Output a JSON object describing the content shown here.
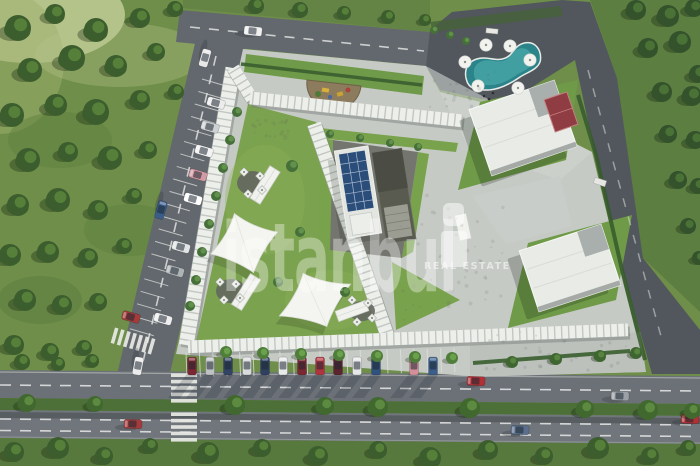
{
  "meta": {
    "caption": "Aerial 3D architectural site-plan rendering"
  },
  "watermark": {
    "brand": "istanbul",
    "tagline": "REAL ESTATE",
    "logo": "i-building-logo"
  },
  "palette": {
    "grass": "#6e8e49",
    "grass_dark": "#5c7e41",
    "grass_bottom": "#58793e",
    "grass_light": "#cbd49f",
    "lawn": "#79a24d",
    "lawn_bright": "#8fb35c",
    "hedge": "#3a5f2f",
    "tree": "#3c5d2d",
    "tree_light": "#56803a",
    "tree_dark": "#34522b",
    "tree_dark_light": "#4a7136",
    "road": "#62686d",
    "road_light": "#70767c",
    "asphalt_dark": "#4d5358",
    "road_right": "#575d63",
    "plaza": "#c6cac5",
    "plaza_shade": "#b7bcb8",
    "colonnade": "#edefeb",
    "colonnade_rib": "#c2c7c2",
    "colonnade_shadow": "#777c78",
    "roof_white": "#e9ebe7",
    "roof_gray": "#a9afad",
    "solar": "#2a4d7a",
    "solar_grid": "#b9c6d8",
    "pool": "#2a8489",
    "pool_light": "#46a3a6",
    "court_red": "#8f3c42",
    "sail": "#f4f5f0",
    "marking": "#e8e8e8",
    "median_green": "#4c7038",
    "pad_gray": "#74756e",
    "kiosk_white": "#f1f2ee"
  },
  "scene": {
    "trees": {
      "field": [
        [
          18,
          28,
          13
        ],
        [
          55,
          14,
          10
        ],
        [
          96,
          30,
          12
        ],
        [
          140,
          18,
          10
        ],
        [
          175,
          9,
          8
        ],
        [
          30,
          70,
          12
        ],
        [
          72,
          58,
          13
        ],
        [
          116,
          66,
          11
        ],
        [
          156,
          52,
          9
        ],
        [
          12,
          115,
          12
        ],
        [
          56,
          105,
          11
        ],
        [
          96,
          112,
          13
        ],
        [
          140,
          100,
          10
        ],
        [
          176,
          92,
          8
        ],
        [
          28,
          160,
          12
        ],
        [
          68,
          152,
          10
        ],
        [
          110,
          158,
          12
        ],
        [
          148,
          150,
          9
        ],
        [
          18,
          205,
          11
        ],
        [
          58,
          200,
          12
        ],
        [
          98,
          210,
          10
        ],
        [
          134,
          196,
          8
        ],
        [
          10,
          255,
          11
        ],
        [
          48,
          252,
          11
        ],
        [
          88,
          258,
          10
        ],
        [
          124,
          246,
          8
        ],
        [
          25,
          300,
          11
        ],
        [
          62,
          305,
          10
        ],
        [
          98,
          302,
          9
        ],
        [
          14,
          345,
          10
        ],
        [
          50,
          352,
          9
        ],
        [
          84,
          348,
          8
        ],
        [
          22,
          362,
          8
        ],
        [
          58,
          364,
          7
        ],
        [
          92,
          361,
          7
        ]
      ],
      "topRight": [
        [
          636,
          10,
          10
        ],
        [
          668,
          16,
          11
        ],
        [
          694,
          8,
          9
        ],
        [
          648,
          48,
          10
        ],
        [
          680,
          42,
          11
        ],
        [
          698,
          74,
          9
        ],
        [
          662,
          92,
          10
        ],
        [
          692,
          96,
          10
        ],
        [
          668,
          134,
          9
        ],
        [
          695,
          140,
          9
        ],
        [
          678,
          180,
          9
        ],
        [
          698,
          186,
          8
        ],
        [
          688,
          226,
          8
        ],
        [
          699,
          258,
          7
        ]
      ],
      "bottom": [
        [
          14,
          452,
          10
        ],
        [
          58,
          448,
          11
        ],
        [
          104,
          456,
          9
        ],
        [
          150,
          446,
          8
        ],
        [
          208,
          453,
          11
        ],
        [
          262,
          448,
          9
        ],
        [
          318,
          456,
          10
        ],
        [
          378,
          450,
          9
        ],
        [
          430,
          458,
          11
        ],
        [
          488,
          450,
          10
        ],
        [
          544,
          456,
          9
        ],
        [
          598,
          448,
          11
        ],
        [
          650,
          456,
          9
        ],
        [
          688,
          448,
          8
        ]
      ],
      "topBand": [
        [
          256,
          6,
          8
        ],
        [
          300,
          10,
          8
        ],
        [
          344,
          13,
          7
        ],
        [
          388,
          17,
          7
        ],
        [
          425,
          20,
          6
        ]
      ],
      "median": [
        [
          27,
          403,
          9
        ],
        [
          95,
          404,
          8
        ],
        [
          235,
          405,
          10
        ],
        [
          325,
          406,
          9
        ],
        [
          378,
          407,
          10
        ],
        [
          470,
          408,
          10
        ],
        [
          585,
          409,
          9
        ],
        [
          648,
          410,
          10
        ],
        [
          692,
          411,
          8
        ]
      ]
    },
    "shrubs": [
      [
        237,
        112,
        5
      ],
      [
        230,
        140,
        5
      ],
      [
        223,
        168,
        5
      ],
      [
        216,
        196,
        5
      ],
      [
        209,
        224,
        5
      ],
      [
        202,
        252,
        5
      ],
      [
        196,
        280,
        5
      ],
      [
        190,
        306,
        5
      ],
      [
        292,
        166,
        6
      ],
      [
        300,
        232,
        5
      ],
      [
        278,
        282,
        5
      ],
      [
        345,
        292,
        5
      ],
      [
        434,
        30,
        4
      ],
      [
        450,
        35,
        4
      ],
      [
        466,
        41,
        4
      ],
      [
        330,
        134,
        4
      ],
      [
        360,
        138,
        4
      ],
      [
        390,
        143,
        4
      ],
      [
        418,
        147,
        4
      ]
    ],
    "hedgeTrees": [
      [
        512,
        362,
        6
      ],
      [
        556,
        359,
        6
      ],
      [
        600,
        356,
        6
      ],
      [
        636,
        353,
        6
      ]
    ],
    "palms": [
      [
        226,
        352
      ],
      [
        263,
        353
      ],
      [
        301,
        354
      ],
      [
        339,
        355
      ],
      [
        377,
        356
      ],
      [
        415,
        357
      ],
      [
        452,
        358
      ]
    ],
    "umbrellas": [
      [
        465,
        62
      ],
      [
        486,
        45
      ],
      [
        510,
        46
      ],
      [
        530,
        60
      ],
      [
        518,
        88
      ],
      [
        478,
        86
      ]
    ],
    "parasols": [
      [
        244,
        172
      ],
      [
        260,
        176
      ],
      [
        248,
        194
      ],
      [
        262,
        190
      ],
      [
        220,
        282
      ],
      [
        236,
        284
      ],
      [
        224,
        300
      ],
      [
        240,
        298
      ],
      [
        352,
        300
      ],
      [
        368,
        303
      ],
      [
        357,
        322
      ],
      [
        372,
        318
      ]
    ],
    "people": [
      [
        484,
        96
      ],
      [
        489,
        99
      ],
      [
        493,
        93
      ]
    ],
    "colonnade": [
      {
        "x1": 233,
        "y1": 68,
        "x2": 186,
        "y2": 345,
        "w": 15
      },
      {
        "x1": 233,
        "y1": 68,
        "x2": 252,
        "y2": 99,
        "w": 13
      },
      {
        "x1": 250,
        "y1": 98,
        "x2": 462,
        "y2": 121,
        "w": 13
      },
      {
        "x1": 314,
        "y1": 124,
        "x2": 388,
        "y2": 338,
        "w": 14
      },
      {
        "x1": 188,
        "y1": 347,
        "x2": 628,
        "y2": 330,
        "w": 13
      }
    ],
    "stalls": {
      "left": {
        "x1": 226,
        "y1": 86,
        "x2": 152,
        "y2": 342,
        "step": 13,
        "dx": -24,
        "dy": -7
      },
      "bottom": {
        "x1": 187,
        "y1": 377,
        "x2": 468,
        "y2": 372,
        "step": 13.4,
        "dx": -1,
        "dy": -24
      }
    },
    "zebras": [
      {
        "cx": 133,
        "cy": 341,
        "rot": 16,
        "count": 7,
        "step": 6.4,
        "len": 16,
        "w": 3.6
      },
      {
        "cx": 184,
        "cy": 388,
        "rot": 90,
        "count": 5,
        "step": 6.4,
        "len": 26,
        "w": 3.6
      },
      {
        "cx": 184,
        "cy": 427,
        "rot": 90,
        "count": 5,
        "step": 6.4,
        "len": 26,
        "w": 3.6
      }
    ],
    "cars": {
      "parkedLeft": [
        [
          216,
          103,
          "#ececec"
        ],
        [
          210,
          127,
          "#cfd2d4"
        ],
        [
          204,
          151,
          "#f2f2f2"
        ],
        [
          198,
          175,
          "#d49aa4"
        ],
        [
          193,
          199,
          "#ffffff"
        ],
        [
          181,
          247,
          "#e2e4e5"
        ],
        [
          175,
          271,
          "#aeb3b6"
        ],
        [
          163,
          319,
          "#eeeeee"
        ],
        [
          131,
          317,
          "#a33b3b"
        ]
      ],
      "parkedBottom": [
        [
          192,
          "#7b2833"
        ],
        [
          210,
          "#bfc2c5"
        ],
        [
          228,
          "#324364"
        ],
        [
          247,
          "#d9dbdd"
        ],
        [
          265,
          "#2f4061"
        ],
        [
          283,
          "#e8e9ea"
        ],
        [
          302,
          "#7b2833"
        ],
        [
          320,
          "#b0343f"
        ],
        [
          338,
          "#5c2430"
        ],
        [
          357,
          "#e6e7e8"
        ],
        [
          376,
          "#32517e"
        ],
        [
          414,
          "#d58f9a"
        ],
        [
          433,
          "#3a5d8a"
        ]
      ],
      "road": [
        [
          253,
          31,
          "#f0f0f0",
          6
        ],
        [
          205,
          58,
          "#e8e8e8",
          106
        ],
        [
          161,
          210,
          "#3a5d8a",
          106
        ],
        [
          138,
          366,
          "#ececec",
          100
        ],
        [
          476,
          381,
          "#b03036",
          2
        ],
        [
          620,
          396,
          "#9aa0a6",
          2
        ],
        [
          520,
          430,
          "#5b6f8d",
          2
        ],
        [
          133,
          424,
          "#a33b3b",
          2
        ],
        [
          690,
          419,
          "#b03036",
          2
        ]
      ]
    }
  }
}
